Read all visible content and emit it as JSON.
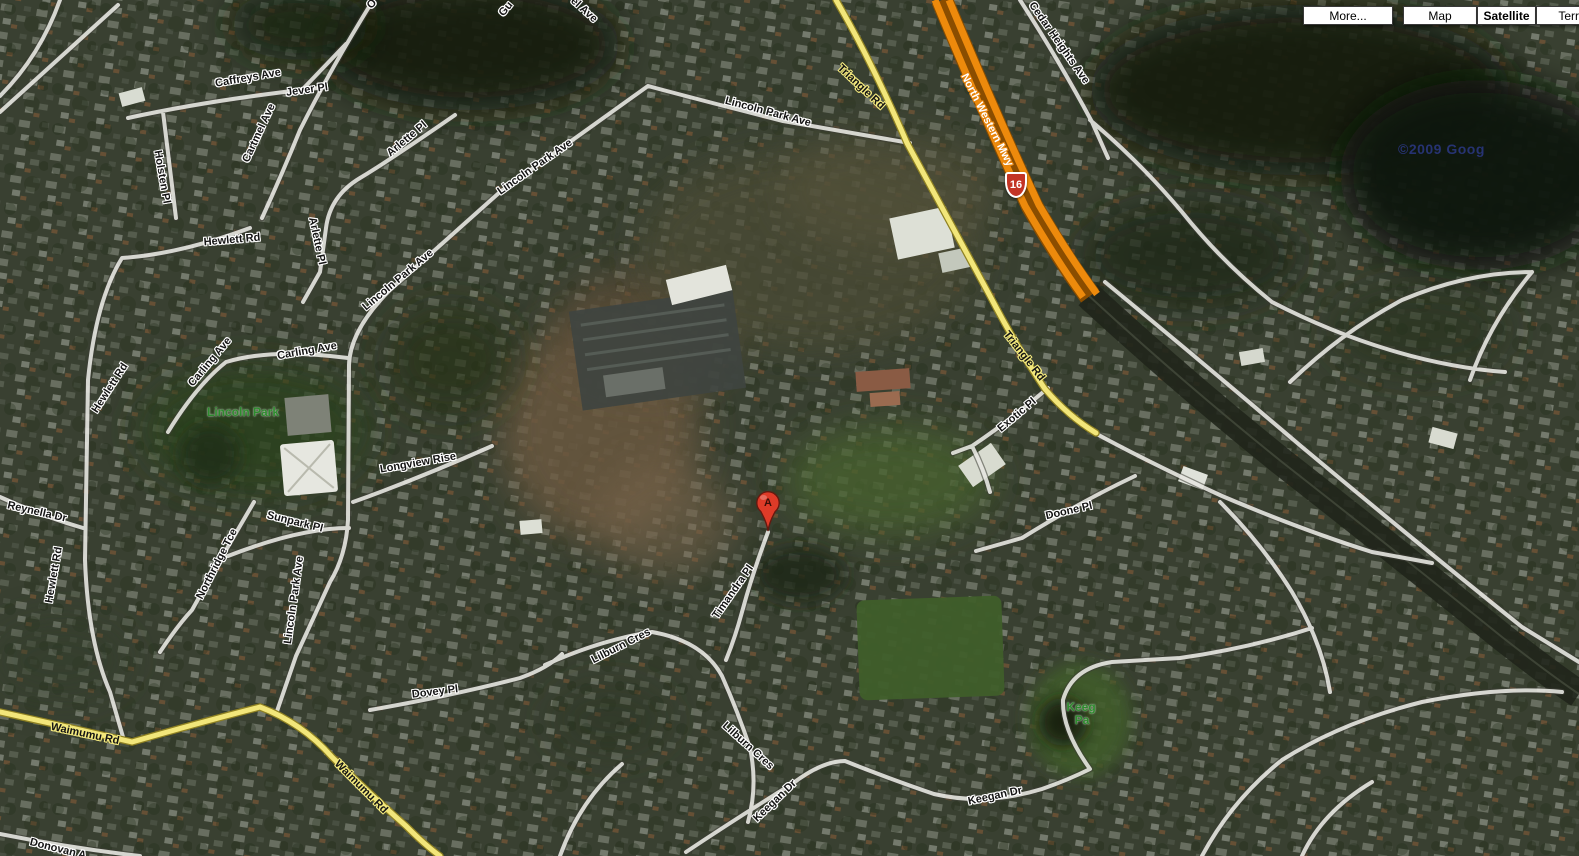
{
  "controls": {
    "more_label": "More...",
    "map_label": "Map",
    "satellite_label": "Satellite",
    "terrain_label": "Terra"
  },
  "marker": {
    "letter": "A"
  },
  "highway_shield": {
    "number": "16"
  },
  "watermark": {
    "text": "©2009 Goog"
  },
  "colors": {
    "road_yellow": "#F2E67A",
    "motorway_orange": "#ED8A0C",
    "shield_red": "#C33425",
    "park_label_green": "#2E8B2E",
    "road_white": "#FCFCF8"
  },
  "map": {
    "labels": [
      {
        "text": "Caffreys Ave",
        "x": 248,
        "y": 78,
        "rot": -10,
        "style": "white"
      },
      {
        "text": "Jever Pl",
        "x": 307,
        "y": 90,
        "rot": -8,
        "style": "white"
      },
      {
        "text": "Cartmel Ave",
        "x": 259,
        "y": 133,
        "rot": -65,
        "style": "white"
      },
      {
        "text": "Holsten Pl",
        "x": 162,
        "y": 177,
        "rot": 80,
        "style": "white"
      },
      {
        "text": "Hewlett Rd",
        "x": 232,
        "y": 240,
        "rot": -5,
        "style": "white"
      },
      {
        "text": "Hewlett Rd",
        "x": 110,
        "y": 388,
        "rot": -57,
        "style": "white"
      },
      {
        "text": "Hewlett Rd",
        "x": 54,
        "y": 575,
        "rot": -80,
        "style": "white"
      },
      {
        "text": "Reynella Dr",
        "x": 37,
        "y": 512,
        "rot": 13,
        "style": "white"
      },
      {
        "text": "Carling Ave",
        "x": 210,
        "y": 362,
        "rot": -50,
        "style": "white"
      },
      {
        "text": "Carling Ave",
        "x": 307,
        "y": 351,
        "rot": -10,
        "style": "white"
      },
      {
        "text": "Lincoln Park",
        "x": 243,
        "y": 412,
        "rot": 0,
        "style": "park"
      },
      {
        "text": "Arlette Pl",
        "x": 407,
        "y": 139,
        "rot": -40,
        "style": "white"
      },
      {
        "text": "Arlette Pl",
        "x": 317,
        "y": 241,
        "rot": 78,
        "style": "white"
      },
      {
        "text": "Lincoln Park Ave",
        "x": 768,
        "y": 112,
        "rot": 15,
        "style": "white"
      },
      {
        "text": "Lincoln Park Ave",
        "x": 535,
        "y": 167,
        "rot": -35,
        "style": "white"
      },
      {
        "text": "Lincoln Park Ave",
        "x": 398,
        "y": 280,
        "rot": -40,
        "style": "white"
      },
      {
        "text": "Lincoln Park Ave",
        "x": 294,
        "y": 600,
        "rot": -82,
        "style": "white"
      },
      {
        "text": "Longview Rise",
        "x": 418,
        "y": 463,
        "rot": -10,
        "style": "white"
      },
      {
        "text": "Sunpark Pl",
        "x": 295,
        "y": 522,
        "rot": 14,
        "style": "white"
      },
      {
        "text": "Northridge Tce",
        "x": 217,
        "y": 564,
        "rot": -63,
        "style": "white"
      },
      {
        "text": "Dovey Pl",
        "x": 435,
        "y": 692,
        "rot": -7,
        "style": "white"
      },
      {
        "text": "Lilburn Cres",
        "x": 621,
        "y": 646,
        "rot": -27,
        "style": "white"
      },
      {
        "text": "Lilburn Cres",
        "x": 748,
        "y": 746,
        "rot": 42,
        "style": "white"
      },
      {
        "text": "Timandra Pl",
        "x": 733,
        "y": 592,
        "rot": -55,
        "style": "white"
      },
      {
        "text": "Exotic Pl",
        "x": 1017,
        "y": 415,
        "rot": -40,
        "style": "white"
      },
      {
        "text": "Doone Pl",
        "x": 1069,
        "y": 511,
        "rot": -13,
        "style": "white"
      },
      {
        "text": "Keegan Dr",
        "x": 775,
        "y": 801,
        "rot": -44,
        "style": "white"
      },
      {
        "text": "Keegan Dr",
        "x": 995,
        "y": 796,
        "rot": -12,
        "style": "white"
      },
      {
        "text": "Keeg",
        "x": 1081,
        "y": 707,
        "rot": 0,
        "style": "park"
      },
      {
        "text": "Pa",
        "x": 1082,
        "y": 720,
        "rot": 0,
        "style": "park"
      },
      {
        "text": "Cedar Heights Ave",
        "x": 1059,
        "y": 43,
        "rot": 55,
        "style": "white"
      },
      {
        "text": "Triangle Rd",
        "x": 861,
        "y": 87,
        "rot": 43,
        "style": "yellow"
      },
      {
        "text": "Triangle Rd",
        "x": 1024,
        "y": 356,
        "rot": 52,
        "style": "yellow"
      },
      {
        "text": "North Western Mwy",
        "x": 987,
        "y": 120,
        "rot": 63,
        "style": "orange"
      },
      {
        "text": "Waimumu Rd",
        "x": 85,
        "y": 734,
        "rot": 12,
        "style": "yellow"
      },
      {
        "text": "Waimumu Rd",
        "x": 361,
        "y": 787,
        "rot": 45,
        "style": "yellow"
      },
      {
        "text": "Donovan A",
        "x": 58,
        "y": 849,
        "rot": 14,
        "style": "white"
      },
      {
        "text": "Gu",
        "x": 506,
        "y": 9,
        "rot": -50,
        "style": "white"
      },
      {
        "text": "el Ave",
        "x": 584,
        "y": 10,
        "rot": 42,
        "style": "white"
      },
      {
        "text": "O",
        "x": 372,
        "y": 4,
        "rot": -50,
        "style": "white"
      }
    ]
  }
}
